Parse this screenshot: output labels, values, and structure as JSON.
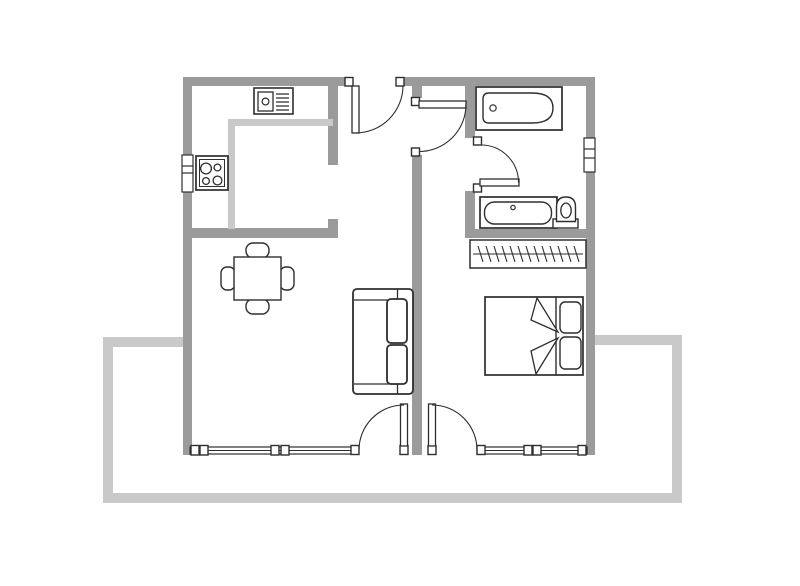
{
  "meta": {
    "title": "apartment-floor-plan"
  },
  "canvas": {
    "width": 800,
    "height": 586,
    "background": "#ffffff"
  },
  "colors": {
    "wall": "#9b9b9b",
    "light": "#c9c9c9",
    "outline": "#2e2e2e",
    "white": "#ffffff"
  },
  "legend": {
    "wall_color_meaning": "structural walls",
    "light_color_meaning": "terrace outline and kitchen counter edge"
  },
  "shapes": [
    {
      "name": "balcony-left-stub",
      "type": "rect",
      "x": 103,
      "y": 337,
      "w": 84,
      "h": 10,
      "fill": "$light"
    },
    {
      "name": "balcony-left-edge",
      "type": "rect",
      "x": 103,
      "y": 337,
      "w": 10,
      "h": 166,
      "fill": "$light"
    },
    {
      "name": "balcony-bottom-edge",
      "type": "rect",
      "x": 103,
      "y": 493,
      "w": 579,
      "h": 10,
      "fill": "$light"
    },
    {
      "name": "balcony-right-edge",
      "type": "rect",
      "x": 672,
      "y": 335,
      "w": 10,
      "h": 168,
      "fill": "$light"
    },
    {
      "name": "balcony-right-stub",
      "type": "rect",
      "x": 595,
      "y": 335,
      "w": 87,
      "h": 10,
      "fill": "$light"
    },
    {
      "name": "wall-top-left",
      "type": "rect",
      "x": 183,
      "y": 77,
      "w": 163,
      "h": 9,
      "fill": "$wall"
    },
    {
      "name": "wall-top-right",
      "type": "rect",
      "x": 404,
      "y": 77,
      "w": 191,
      "h": 9,
      "fill": "$wall"
    },
    {
      "name": "wall-left",
      "type": "rect",
      "x": 183,
      "y": 77,
      "w": 9,
      "h": 378,
      "fill": "$wall"
    },
    {
      "name": "wall-right",
      "type": "rect",
      "x": 586,
      "y": 77,
      "w": 9,
      "h": 378,
      "fill": "$wall"
    },
    {
      "name": "wall-bottom-left-corner",
      "type": "rect",
      "x": 183,
      "y": 446,
      "w": 9,
      "h": 9,
      "fill": "$wall"
    },
    {
      "name": "wall-bottom-right-corner",
      "type": "rect",
      "x": 586,
      "y": 446,
      "w": 9,
      "h": 9,
      "fill": "$wall"
    },
    {
      "name": "wall-kitchen-partition",
      "type": "rect",
      "x": 328,
      "y": 86,
      "w": 10,
      "h": 79,
      "fill": "$wall"
    },
    {
      "name": "wall-kitchen-stub",
      "type": "rect",
      "x": 328,
      "y": 219,
      "w": 10,
      "h": 9,
      "fill": "$wall"
    },
    {
      "name": "wall-kitchen-bottom",
      "type": "rect",
      "x": 183,
      "y": 228,
      "w": 155,
      "h": 10,
      "fill": "$wall"
    },
    {
      "name": "wall-middle-upper",
      "type": "rect",
      "x": 412,
      "y": 86,
      "w": 10,
      "h": 12,
      "fill": "$wall"
    },
    {
      "name": "wall-middle-lower",
      "type": "rect",
      "x": 412,
      "y": 155,
      "w": 10,
      "h": 300,
      "fill": "$wall"
    },
    {
      "name": "wall-bathroom-left-upper",
      "type": "rect",
      "x": 465,
      "y": 86,
      "w": 10,
      "h": 52,
      "fill": "$wall"
    },
    {
      "name": "wall-bathroom-left-lower",
      "type": "rect",
      "x": 465,
      "y": 191,
      "w": 10,
      "h": 47,
      "fill": "$wall"
    },
    {
      "name": "wall-bathroom-bottom",
      "type": "rect",
      "x": 465,
      "y": 229,
      "w": 130,
      "h": 9,
      "fill": "$wall"
    },
    {
      "name": "counter-top-edge",
      "type": "rect",
      "x": 228,
      "y": 119,
      "w": 105,
      "h": 7,
      "fill": "$light"
    },
    {
      "name": "counter-left-edge",
      "type": "rect",
      "x": 228,
      "y": 119,
      "w": 7,
      "h": 110,
      "fill": "$light"
    },
    {
      "name": "window-kitchen",
      "type": "rect",
      "x": 182,
      "y": 155,
      "w": 11,
      "h": 37,
      "fill": "$white",
      "stroke": "$outline",
      "sw": 1.2
    },
    {
      "name": "window-kitchen-tick-1",
      "type": "line",
      "x1": 182,
      "y1": 166,
      "x2": 193,
      "y2": 166,
      "stroke": "$outline",
      "sw": 1.2
    },
    {
      "name": "window-kitchen-tick-2",
      "type": "line",
      "x1": 182,
      "y1": 173,
      "x2": 193,
      "y2": 173,
      "stroke": "$outline",
      "sw": 1.2
    },
    {
      "name": "window-bathroom",
      "type": "rect",
      "x": 584,
      "y": 138,
      "w": 11,
      "h": 34,
      "fill": "$white",
      "stroke": "$outline",
      "sw": 1.2
    },
    {
      "name": "window-bathroom-tick-1",
      "type": "line",
      "x1": 584,
      "y1": 149,
      "x2": 595,
      "y2": 149,
      "stroke": "$outline",
      "sw": 1.2
    },
    {
      "name": "window-bathroom-tick-2",
      "type": "line",
      "x1": 584,
      "y1": 158,
      "x2": 595,
      "y2": 158,
      "stroke": "$outline",
      "sw": 1.2
    },
    {
      "name": "window-living-frame",
      "type": "rect",
      "x": 190,
      "y": 447,
      "w": 166,
      "h": 7,
      "fill": "$white",
      "stroke": "$outline",
      "sw": 1.2
    },
    {
      "name": "window-living-mid",
      "type": "line",
      "x1": 190,
      "y1": 450.5,
      "x2": 356,
      "y2": 450.5,
      "stroke": "$outline",
      "sw": 1
    },
    {
      "name": "window-living-post-1",
      "type": "rect",
      "x": 191,
      "y": 445.5,
      "w": 8,
      "h": 9.5,
      "fill": "$white",
      "stroke": "$outline",
      "sw": 1.4
    },
    {
      "name": "window-living-post-2",
      "type": "rect",
      "x": 200,
      "y": 445.5,
      "w": 8,
      "h": 9.5,
      "fill": "$white",
      "stroke": "$outline",
      "sw": 1.4
    },
    {
      "name": "window-living-post-3",
      "type": "rect",
      "x": 271,
      "y": 445.5,
      "w": 8,
      "h": 9.5,
      "fill": "$white",
      "stroke": "$outline",
      "sw": 1.4
    },
    {
      "name": "window-living-post-4",
      "type": "rect",
      "x": 281,
      "y": 445.5,
      "w": 8,
      "h": 9.5,
      "fill": "$white",
      "stroke": "$outline",
      "sw": 1.4
    },
    {
      "name": "window-bedroom-frame",
      "type": "rect",
      "x": 477,
      "y": 447,
      "w": 110,
      "h": 7,
      "fill": "$white",
      "stroke": "$outline",
      "sw": 1.2
    },
    {
      "name": "window-bedroom-mid",
      "type": "line",
      "x1": 477,
      "y1": 450.5,
      "x2": 587,
      "y2": 450.5,
      "stroke": "$outline",
      "sw": 1
    },
    {
      "name": "window-bedroom-post-1",
      "type": "rect",
      "x": 524,
      "y": 445.5,
      "w": 8,
      "h": 9.5,
      "fill": "$white",
      "stroke": "$outline",
      "sw": 1.4
    },
    {
      "name": "window-bedroom-post-2",
      "type": "rect",
      "x": 533,
      "y": 445.5,
      "w": 8,
      "h": 9.5,
      "fill": "$white",
      "stroke": "$outline",
      "sw": 1.4
    },
    {
      "name": "window-bedroom-post-3",
      "type": "rect",
      "x": 578,
      "y": 445.5,
      "w": 8,
      "h": 9.5,
      "fill": "$white",
      "stroke": "$outline",
      "sw": 1.4
    },
    {
      "name": "entrance-door-jamb-left",
      "type": "rect",
      "x": 345,
      "y": 77.5,
      "w": 8,
      "h": 8.5,
      "fill": "$white",
      "stroke": "$outline",
      "sw": 1.4
    },
    {
      "name": "entrance-door-jamb-right",
      "type": "rect",
      "x": 396,
      "y": 77.5,
      "w": 8,
      "h": 8.5,
      "fill": "$white",
      "stroke": "$outline",
      "sw": 1.4
    },
    {
      "name": "entrance-door-leaf",
      "type": "rect",
      "x": 352,
      "y": 86,
      "w": 7,
      "h": 47,
      "fill": "$white",
      "stroke": "$outline",
      "sw": 1.3
    },
    {
      "name": "entrance-door-arc",
      "type": "path",
      "d": "M355.5,133 A47.5,47.5 0 0 0 403,85.5",
      "fill": "none",
      "stroke": "$outline",
      "sw": 1.1
    },
    {
      "name": "hall-door-jamb-top",
      "type": "rect",
      "x": 411.5,
      "y": 97.5,
      "w": 8,
      "h": 8,
      "fill": "$white",
      "stroke": "$outline",
      "sw": 1.4
    },
    {
      "name": "hall-door-jamb-bottom",
      "type": "rect",
      "x": 411.5,
      "y": 148,
      "w": 8,
      "h": 8,
      "fill": "$white",
      "stroke": "$outline",
      "sw": 1.4
    },
    {
      "name": "hall-door-leaf",
      "type": "rect",
      "x": 419,
      "y": 101,
      "w": 47,
      "h": 7,
      "fill": "$white",
      "stroke": "$outline",
      "sw": 1.3
    },
    {
      "name": "hall-door-arc",
      "type": "path",
      "d": "M466,104.5 A47,47 0 0 1 419,151.5",
      "fill": "none",
      "stroke": "$outline",
      "sw": 1.1
    },
    {
      "name": "bathroom-door-jamb-top",
      "type": "rect",
      "x": 473.5,
      "y": 137,
      "w": 8,
      "h": 8,
      "fill": "$white",
      "stroke": "$outline",
      "sw": 1.4
    },
    {
      "name": "bathroom-door-jamb-bottom",
      "type": "rect",
      "x": 473.5,
      "y": 184,
      "w": 8,
      "h": 8,
      "fill": "$white",
      "stroke": "$outline",
      "sw": 1.4
    },
    {
      "name": "bathroom-door-leaf",
      "type": "rect",
      "x": 480,
      "y": 179,
      "w": 39,
      "h": 7,
      "fill": "$white",
      "stroke": "$outline",
      "sw": 1.3
    },
    {
      "name": "bathroom-door-arc",
      "type": "path",
      "d": "M481,145 A37.5,37.5 0 0 1 518.5,182.5",
      "fill": "none",
      "stroke": "$outline",
      "sw": 1.1
    },
    {
      "name": "living-balcony-door-jamb",
      "type": "rect",
      "x": 351,
      "y": 445.5,
      "w": 8,
      "h": 9,
      "fill": "$white",
      "stroke": "$outline",
      "sw": 1.4
    },
    {
      "name": "living-balcony-door-hinge",
      "type": "rect",
      "x": 400,
      "y": 445.5,
      "w": 8,
      "h": 9,
      "fill": "$white",
      "stroke": "$outline",
      "sw": 1.4
    },
    {
      "name": "living-balcony-door-leaf",
      "type": "rect",
      "x": 400.5,
      "y": 404,
      "w": 7,
      "h": 42,
      "fill": "$white",
      "stroke": "$outline",
      "sw": 1.3
    },
    {
      "name": "living-balcony-door-arc",
      "type": "path",
      "d": "M359,450 A45,45 0 0 1 404,405",
      "fill": "none",
      "stroke": "$outline",
      "sw": 1.1
    },
    {
      "name": "bedroom-balcony-door-hinge",
      "type": "rect",
      "x": 428,
      "y": 445.5,
      "w": 8,
      "h": 9,
      "fill": "$white",
      "stroke": "$outline",
      "sw": 1.4
    },
    {
      "name": "bedroom-balcony-door-jamb",
      "type": "rect",
      "x": 477,
      "y": 445.5,
      "w": 8,
      "h": 9,
      "fill": "$white",
      "stroke": "$outline",
      "sw": 1.4
    },
    {
      "name": "bedroom-balcony-door-leaf",
      "type": "rect",
      "x": 428.5,
      "y": 404,
      "w": 7,
      "h": 42,
      "fill": "$white",
      "stroke": "$outline",
      "sw": 1.3
    },
    {
      "name": "bedroom-balcony-door-arc",
      "type": "path",
      "d": "M432,405 A45,45 0 0 1 477,450",
      "fill": "none",
      "stroke": "$outline",
      "sw": 1.1
    },
    {
      "name": "kitchen-sink-outer",
      "type": "rect",
      "x": 254,
      "y": 88,
      "w": 39,
      "h": 26,
      "fill": "$white",
      "stroke": "$outline",
      "sw": 1.6
    },
    {
      "name": "kitchen-sink-basin",
      "type": "rect",
      "x": 258,
      "y": 92,
      "w": 15,
      "h": 19,
      "fill": "$white",
      "stroke": "$outline",
      "sw": 1.3
    },
    {
      "name": "kitchen-sink-drain",
      "type": "circle",
      "cx": 265.5,
      "cy": 101.5,
      "r": 3.4,
      "fill": "$white",
      "stroke": "$outline",
      "sw": 1.2
    },
    {
      "name": "kitchen-sink-drainer-lines",
      "type": "path",
      "d": "M276,94 H289 M276,98 H289 M276,102 H289 M276,106 H289 M276,110 H289",
      "fill": "none",
      "stroke": "$outline",
      "sw": 1.2
    },
    {
      "name": "stove-outer",
      "type": "rect",
      "x": 196,
      "y": 156,
      "w": 32,
      "h": 34,
      "fill": "$white",
      "stroke": "$outline",
      "sw": 1.7
    },
    {
      "name": "stove-inner",
      "type": "rect",
      "x": 199.5,
      "y": 159.5,
      "w": 25,
      "h": 27,
      "fill": "none",
      "stroke": "$outline",
      "sw": 1
    },
    {
      "name": "stove-burner-1",
      "type": "circle",
      "cx": 206,
      "cy": 168.5,
      "r": 5.4,
      "fill": "none",
      "stroke": "$outline",
      "sw": 1.3
    },
    {
      "name": "stove-burner-2",
      "type": "circle",
      "cx": 217.5,
      "cy": 167.5,
      "r": 3.4,
      "fill": "none",
      "stroke": "$outline",
      "sw": 1.3
    },
    {
      "name": "stove-burner-3",
      "type": "circle",
      "cx": 206,
      "cy": 181,
      "r": 3.4,
      "fill": "none",
      "stroke": "$outline",
      "sw": 1.3
    },
    {
      "name": "stove-burner-4",
      "type": "circle",
      "cx": 217.5,
      "cy": 180.5,
      "r": 4.4,
      "fill": "none",
      "stroke": "$outline",
      "sw": 1.3
    },
    {
      "name": "dining-chair-top",
      "type": "rect",
      "x": 246,
      "y": 243,
      "w": 23,
      "h": 15,
      "rx": 7,
      "fill": "$white",
      "stroke": "$outline",
      "sw": 1.4
    },
    {
      "name": "dining-chair-bottom",
      "type": "rect",
      "x": 246,
      "y": 299,
      "w": 23,
      "h": 15,
      "rx": 7,
      "fill": "$white",
      "stroke": "$outline",
      "sw": 1.4
    },
    {
      "name": "dining-chair-left",
      "type": "rect",
      "x": 221,
      "y": 267,
      "w": 14,
      "h": 23,
      "rx": 6,
      "fill": "$white",
      "stroke": "$outline",
      "sw": 1.4
    },
    {
      "name": "dining-chair-right",
      "type": "rect",
      "x": 280,
      "y": 267,
      "w": 14,
      "h": 23,
      "rx": 6,
      "fill": "$white",
      "stroke": "$outline",
      "sw": 1.4
    },
    {
      "name": "dining-table",
      "type": "rect",
      "x": 234,
      "y": 257,
      "w": 47,
      "h": 43,
      "fill": "$white",
      "stroke": "$outline",
      "sw": 1.4
    },
    {
      "name": "sofa-outer",
      "type": "rect",
      "x": 353,
      "y": 289,
      "w": 60,
      "h": 105,
      "rx": 4,
      "fill": "$white",
      "stroke": "$outline",
      "sw": 1.8
    },
    {
      "name": "sofa-frame-lines",
      "type": "path",
      "d": "M354,300 H397 M354,384 H397 M397.5,289.5 V300 M397.5,383.5 V393.5",
      "fill": "none",
      "stroke": "$outline",
      "sw": 1.3
    },
    {
      "name": "sofa-cushion-1",
      "type": "rect",
      "x": 387,
      "y": 299,
      "w": 20,
      "h": 44,
      "rx": 4,
      "fill": "$white",
      "stroke": "$outline",
      "sw": 1.8
    },
    {
      "name": "sofa-cushion-2",
      "type": "rect",
      "x": 387,
      "y": 345,
      "w": 20,
      "h": 39,
      "rx": 4,
      "fill": "$white",
      "stroke": "$outline",
      "sw": 1.8
    },
    {
      "name": "bed-outer",
      "type": "rect",
      "x": 485,
      "y": 297,
      "w": 98,
      "h": 78,
      "fill": "$white",
      "stroke": "$outline",
      "sw": 1.7
    },
    {
      "name": "bed-fold-line",
      "type": "line",
      "x1": 556,
      "y1": 297,
      "x2": 556,
      "y2": 375,
      "stroke": "$outline",
      "sw": 1.4
    },
    {
      "name": "bed-pillow-1",
      "type": "rect",
      "x": 560,
      "y": 302,
      "w": 21,
      "h": 31,
      "rx": 5,
      "fill": "$white",
      "stroke": "$outline",
      "sw": 1.4
    },
    {
      "name": "bed-pillow-2",
      "type": "rect",
      "x": 560,
      "y": 337,
      "w": 21,
      "h": 32,
      "rx": 5,
      "fill": "$white",
      "stroke": "$outline",
      "sw": 1.4
    },
    {
      "name": "bed-blanket-fold-top",
      "type": "polygon",
      "points": "537,298 558,332 531,320",
      "fill": "$white",
      "stroke": "$outline",
      "sw": 1.3
    },
    {
      "name": "bed-blanket-fold-bottom",
      "type": "polygon",
      "points": "536,374 558,338 531,351",
      "fill": "$white",
      "stroke": "$outline",
      "sw": 1.3
    },
    {
      "name": "wardrobe-outer",
      "type": "rect",
      "x": 470,
      "y": 240,
      "w": 116,
      "h": 28,
      "fill": "$white",
      "stroke": "$outline",
      "sw": 1.5
    },
    {
      "name": "wardrobe-rod",
      "type": "line",
      "x1": 473,
      "y1": 254,
      "x2": 583,
      "y2": 254,
      "stroke": "$outline",
      "sw": 1
    },
    {
      "name": "wardrobe-hangers",
      "type": "path",
      "d": "M478,246 L483,262 M491,262 L486,246 M494,246 L499,262 M507,262 L502,246 M510,246 L515,262 M523,262 L518,246 M526,246 L531,262 M539,262 L534,246 M542,246 L547,262 M555,262 L550,246 M558,246 L563,262 M571,262 L566,246 M574,246 L579,262",
      "fill": "none",
      "stroke": "$outline",
      "sw": 1.1
    },
    {
      "name": "bathtub-outer",
      "type": "rect",
      "x": 476,
      "y": 87,
      "w": 86,
      "h": 43,
      "fill": "$white",
      "stroke": "$outline",
      "sw": 1.7
    },
    {
      "name": "bathtub-inner",
      "type": "path",
      "d": "M489,93 H532 Q553,93 553,108 Q553,123 532,123 H489 Q483,123 483,117 V99 Q483,93 489,93 Z",
      "fill": "$white",
      "stroke": "$outline",
      "sw": 1.4
    },
    {
      "name": "bathtub-drain",
      "type": "circle",
      "cx": 493,
      "cy": 108,
      "r": 3.2,
      "fill": "$white",
      "stroke": "$outline",
      "sw": 1.2
    },
    {
      "name": "bathroom-sink-outer",
      "type": "rect",
      "x": 480,
      "y": 197,
      "w": 77,
      "h": 31,
      "fill": "$white",
      "stroke": "$outline",
      "sw": 1.7
    },
    {
      "name": "bathroom-sink-basin",
      "type": "rect",
      "x": 484.5,
      "y": 202,
      "w": 67,
      "h": 22,
      "rx": 10,
      "fill": "$white",
      "stroke": "$outline",
      "sw": 1.4
    },
    {
      "name": "bathroom-sink-faucet",
      "type": "circle",
      "cx": 513,
      "cy": 207.5,
      "r": 2.2,
      "fill": "$white",
      "stroke": "$outline",
      "sw": 1.2
    },
    {
      "name": "toilet-base",
      "type": "rect",
      "x": 553,
      "y": 219,
      "w": 25,
      "h": 9,
      "fill": "$white",
      "stroke": "$outline",
      "sw": 1.4
    },
    {
      "name": "toilet-bowl-outer",
      "type": "path",
      "d": "M556.5,221.5 V207 Q556.5,197 566,197 Q575.5,197 575.5,207 V221.5 Z",
      "fill": "$white",
      "stroke": "$outline",
      "sw": 1.4
    },
    {
      "name": "toilet-bowl-inner",
      "type": "ellipse",
      "cx": 566,
      "cy": 210.5,
      "rx": 5.2,
      "ry": 7.4,
      "fill": "$white",
      "stroke": "$outline",
      "sw": 1.3
    }
  ]
}
